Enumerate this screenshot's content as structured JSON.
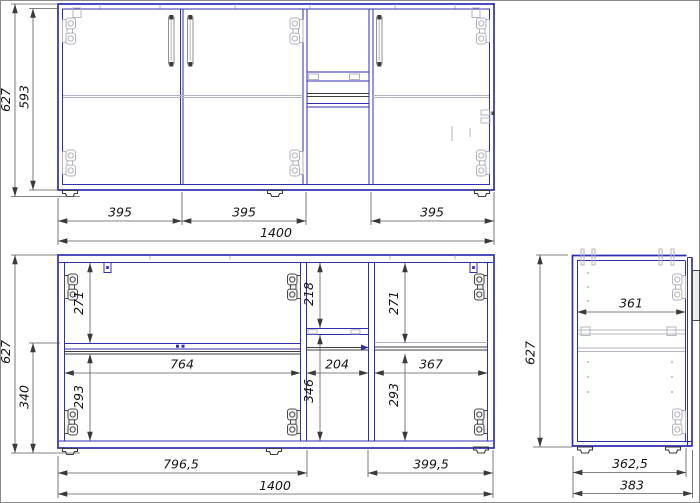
{
  "drawing": {
    "title": "Cabinet assembly drawing, three views",
    "unit": "mm",
    "colors": {
      "outline_blue": "#2e2eb0",
      "detail_gray": "#b4b4c0",
      "detail_dark": "#3d3d3d",
      "dimension_text": "#151515"
    }
  },
  "views": {
    "front": {
      "label": "front exterior view",
      "dims": {
        "height_total": "627",
        "height_body": "593",
        "door1_width": "395",
        "door2_width": "395",
        "door3_width": "395",
        "width_total": "1400"
      }
    },
    "carcass": {
      "label": "front internal view",
      "dims": {
        "height_total": "627",
        "height_base_to_shelf": "340",
        "left_upper_height": "271",
        "left_lower_height": "293",
        "center_upper_height": "218",
        "center_lower_height": "346",
        "right_upper_height": "271",
        "right_lower_height": "293",
        "left_inner_width": "764",
        "center_inner_width": "204",
        "right_inner_width": "367",
        "left_outer_width": "796,5",
        "right_outer_width": "399,5",
        "width_total": "1400"
      }
    },
    "side": {
      "label": "side view",
      "dims": {
        "height_total": "627",
        "inner_depth": "361",
        "body_depth": "362,5",
        "depth_total": "383"
      }
    }
  }
}
